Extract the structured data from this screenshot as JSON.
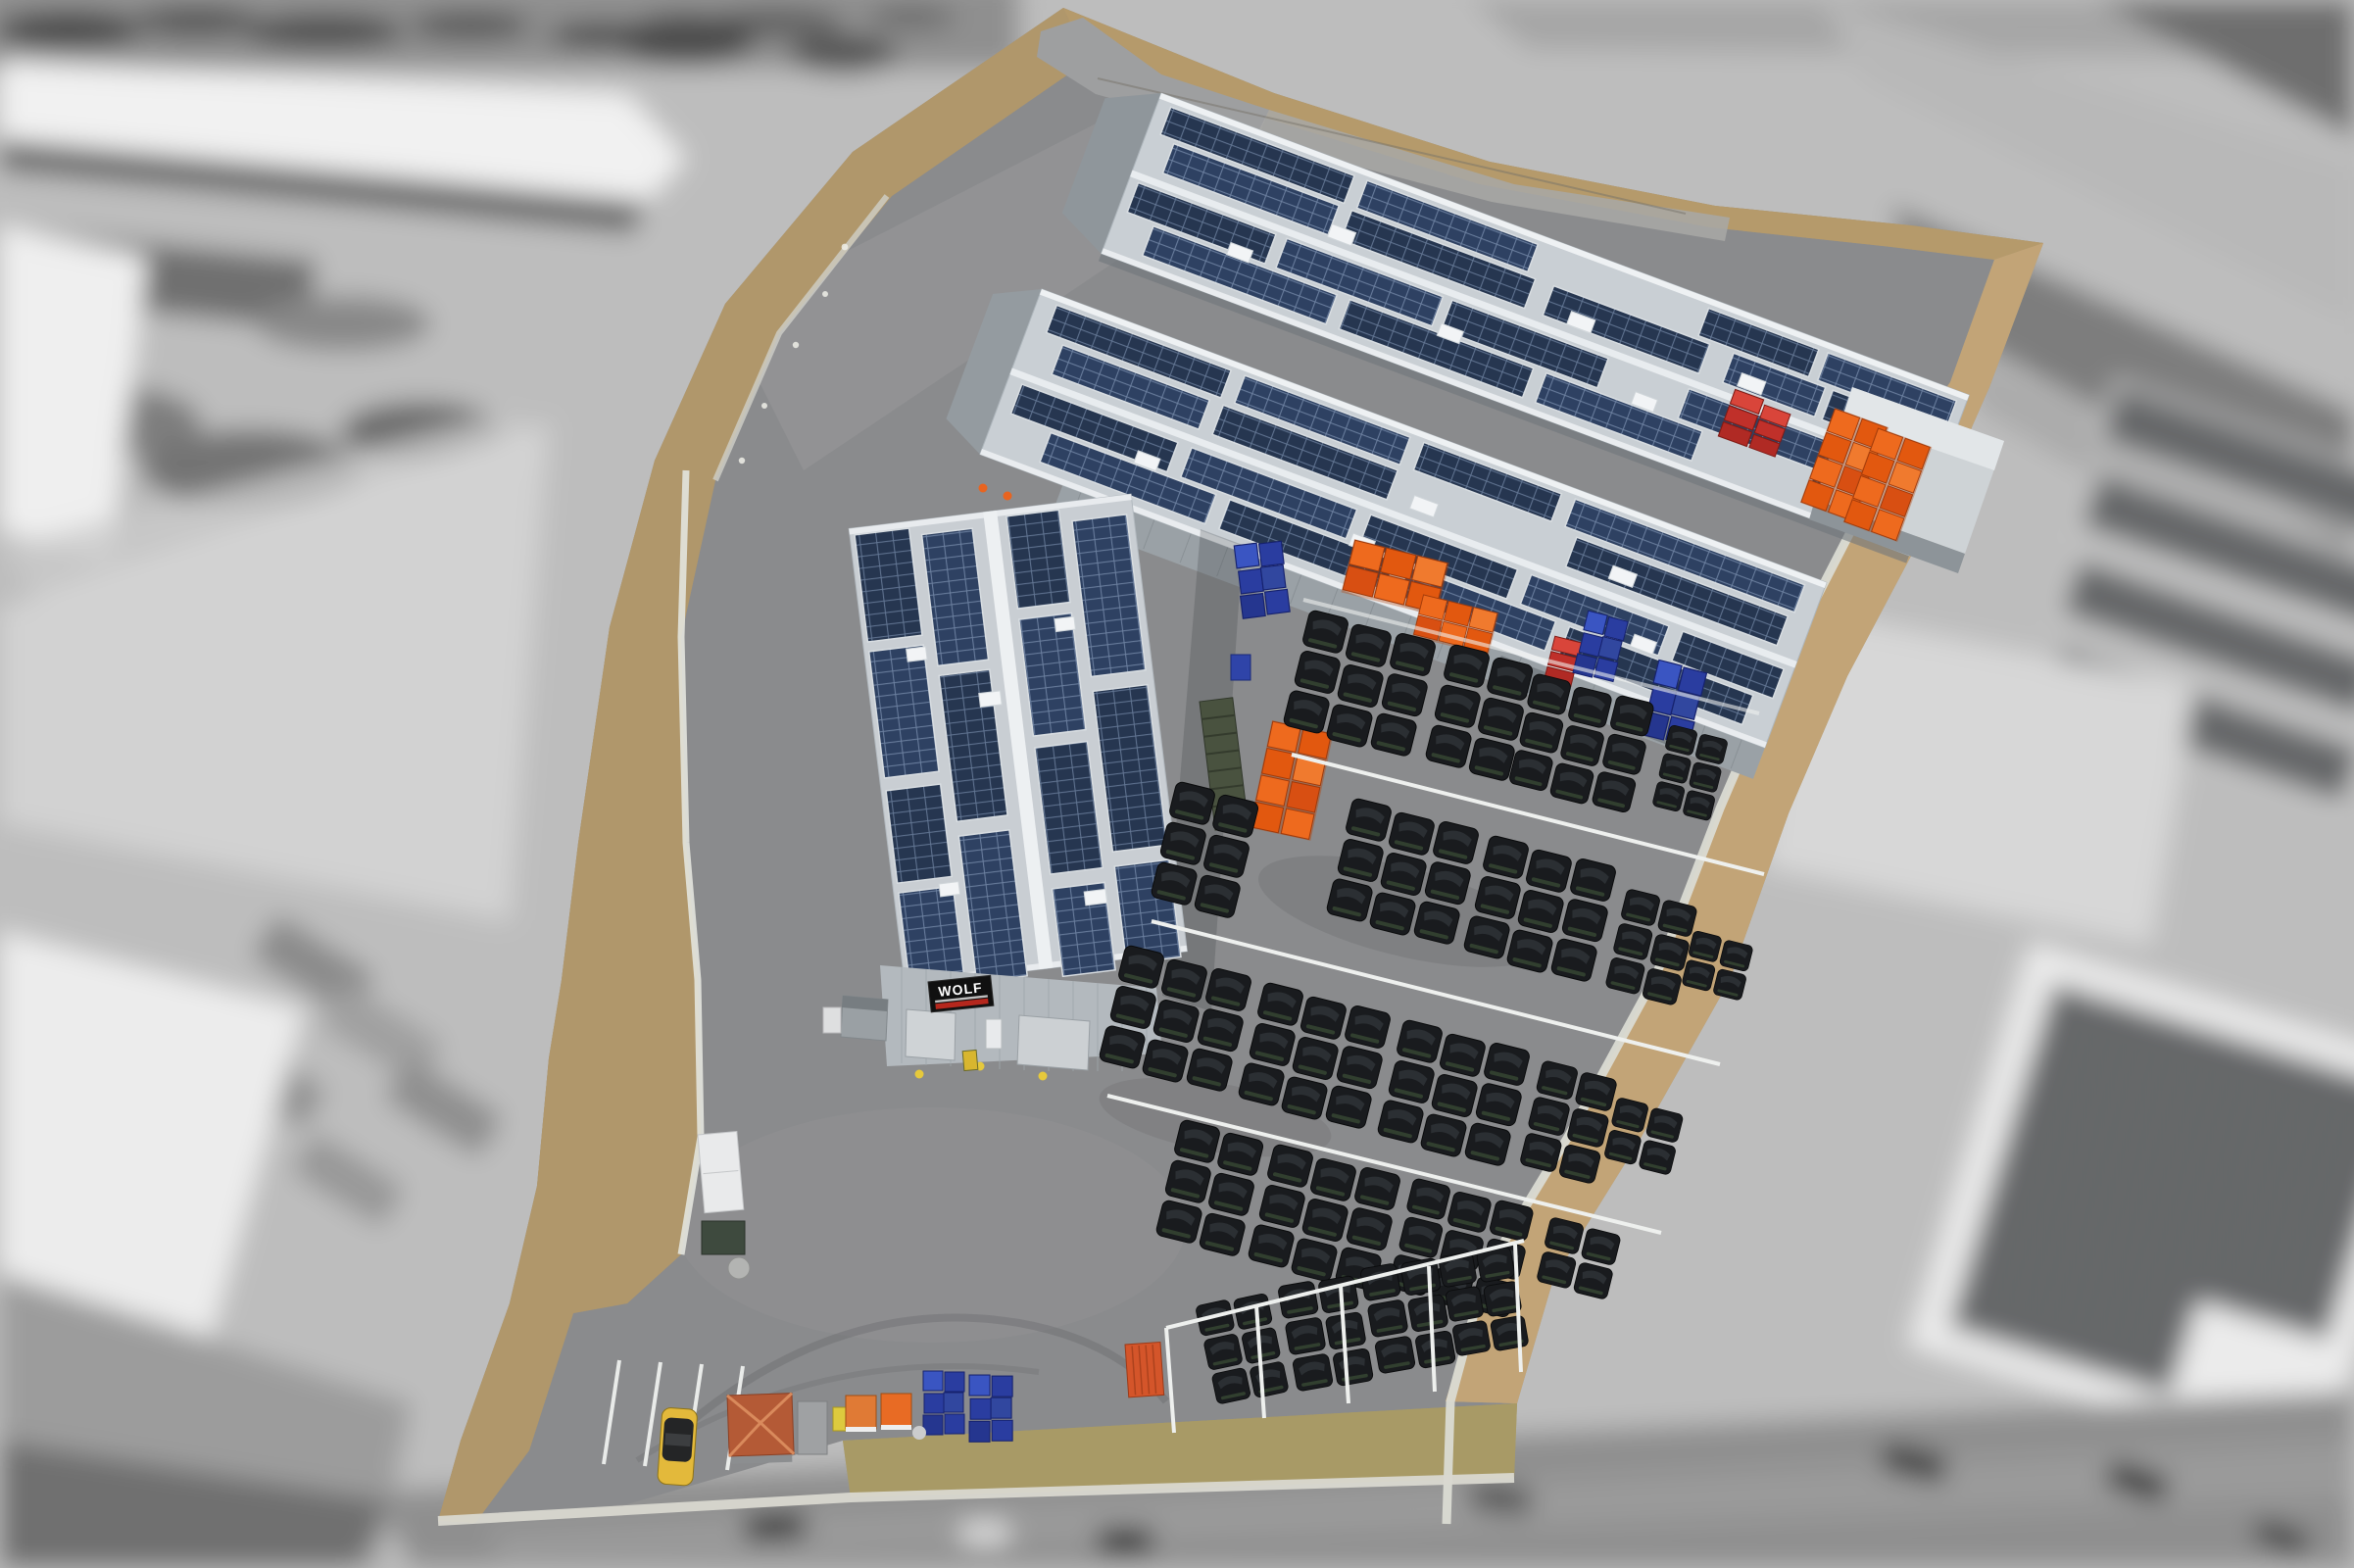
{
  "meta": {
    "image_type": "aerial drone photograph",
    "subject": "recycling / waste-handling company premises with solar-panel warehouse roofs",
    "effect": "property shown in full color, surroundings desaturated (grayscale) and blurred"
  },
  "signage": {
    "building_sign": {
      "text": "WOLF",
      "bg": "#101010",
      "text_color": "#ffffff",
      "accent_line_color": "#b5271d"
    }
  },
  "palette": {
    "asphalt": "#8a8b8d",
    "dirt_border": "#b79a6c",
    "grass_fleck": "#77794a",
    "roof_light": "#c9cfd4",
    "roof_ridge": "#edf0f2",
    "solar_panel": "#263650",
    "solar_grid": "#7d92b0",
    "wall_gray": "#9aa1a6",
    "rail_white": "#eef0ee",
    "bag_black": "#191b1e",
    "crate_orange": "#ee6a1e",
    "crate_blue": "#2a3da0",
    "container_red": "#c0302a",
    "car_yellow": "#e3b93b",
    "hut_roof": "#b45a36",
    "background_gray": "#bdbdbd"
  },
  "property": {
    "halls": [
      {
        "id": "north-hall",
        "solar_roof": true
      },
      {
        "id": "middle-hall",
        "solar_roof": true
      },
      {
        "id": "west-hall",
        "solar_roof": true,
        "sign": "WOLF"
      }
    ],
    "storage": {
      "black_bag_rows": 4,
      "bottom_bag_pens": 4,
      "orange_crate_stacks": 6,
      "blue_crate_stacks": 5,
      "red_container_stacks": 2
    },
    "vehicles": {
      "yellow_car": 1,
      "white_trailer": 1,
      "green_cage_trailer": 1
    },
    "parking_stall_lines": 4
  },
  "background": {
    "desaturated": true,
    "blurred": true,
    "features": [
      "industrial storage yards",
      "white flat roofs",
      "roads with cars",
      "ground-mounted solar farm",
      "large solar-roof building bottom right"
    ]
  }
}
